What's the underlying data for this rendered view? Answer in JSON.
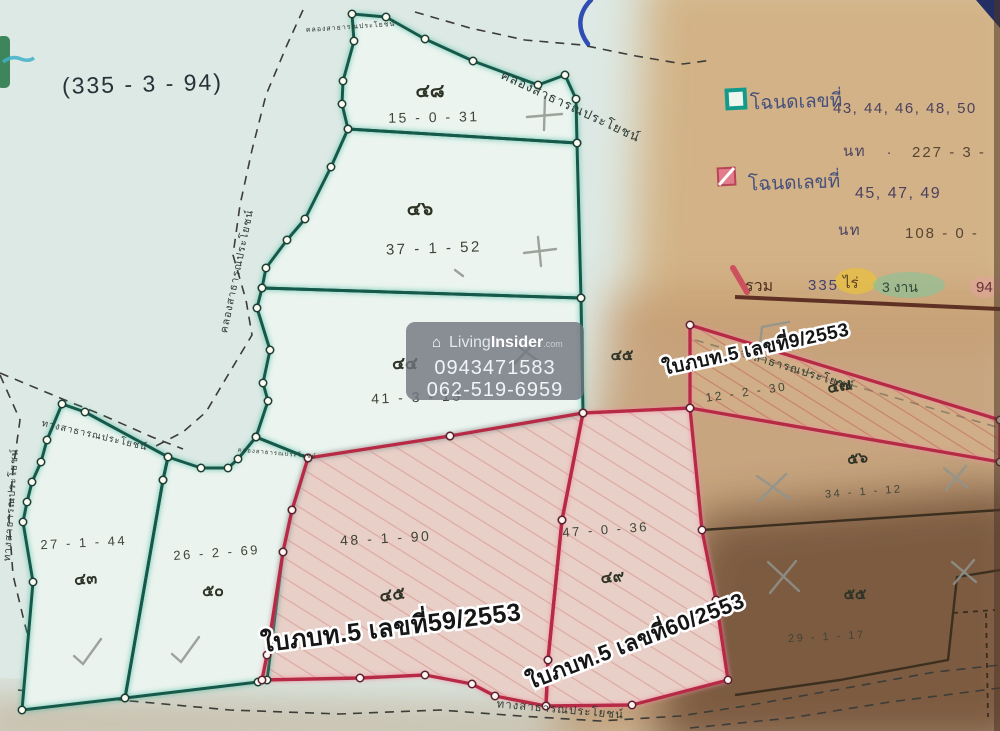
{
  "header": {
    "survey_total_note": "(335 - 3 - 94)"
  },
  "watermark": {
    "house_icon": "⌂",
    "brand_prefix": "Living",
    "brand_suffix": "Insider",
    "brand_tld": ".com",
    "phone_primary": "0943471583",
    "phone_secondary": "062-519-6959"
  },
  "legend": {
    "teal_group": {
      "label": "โฉนดเลขที่",
      "deed_numbers": "43, 44, 46, 48, 50",
      "area_label": "นท",
      "area_sep": ".",
      "area_value": "227 - 3 -"
    },
    "pink_group": {
      "label": "โฉนดเลขที่",
      "deed_numbers": "45, 47, 49",
      "area_label": "นท",
      "area_sep": ".",
      "area_value": "108 - 0 -"
    },
    "total": {
      "label": "รวม",
      "rai_value": "335",
      "rai_unit": "ไร่",
      "ngan_value": "3 งาน",
      "wa_value": "94"
    }
  },
  "plots": {
    "p48": {
      "deed_no": "๔๘",
      "area": "15 - 0 - 31"
    },
    "p46": {
      "deed_no": "๔๖",
      "area": "37 - 1 - 52"
    },
    "p44": {
      "deed_no": "๔๔",
      "area": "41 - 3 - 13"
    },
    "p43": {
      "deed_no": "๔๓",
      "area": "27 - 1 - 44"
    },
    "p50": {
      "deed_no": "๕๐",
      "area": "26 - 2 - 69"
    },
    "p45": {
      "deed_no": "๔๕",
      "area": "48 - 1 - 90"
    },
    "p49": {
      "deed_no": "๔๙",
      "area": "47 - 0 - 36"
    },
    "p47": {
      "deed_no": "๔๗",
      "area": "12 - 2 - 30"
    },
    "p56": {
      "deed_no": "๕๖",
      "area": "34 - 1 - 12"
    },
    "p55": {
      "deed_no": "๕๕",
      "area": "29 - 1 - 17"
    },
    "stray": {
      "deed_no": "๔๕"
    }
  },
  "stamps": {
    "receipt_59": "ใบภบท.5 เลขที่59/2553",
    "receipt_60": "ใบภบท.5 เลขที่60/2553",
    "receipt_9": "ใบภบท.5 เลขที่9/2553"
  },
  "roads": {
    "canal_top": "คลองสาธารณประโยชน์",
    "canal_top_small": "คลองสาธารณประโยชน์",
    "canal_west": "คลองสาธารณประโยชน์",
    "canal_mid_small": "คลองสาธารณประโยชน์",
    "road_nw": "ทางสาธารณประโยชน์",
    "road_far_west": "ทางสาธารณประโยชน์",
    "road_wedge": "ทางสาธารณประโยชน์",
    "road_south": "ทางสาธารณประโยชน์"
  },
  "colors": {
    "teal_boundary": "#14594a",
    "red_boundary": "#b62c44",
    "legend_teal": "#129b8a",
    "legend_pink": "#e4798c",
    "highlight_yellow": "#e9c23c",
    "highlight_green": "#7fc49b"
  }
}
